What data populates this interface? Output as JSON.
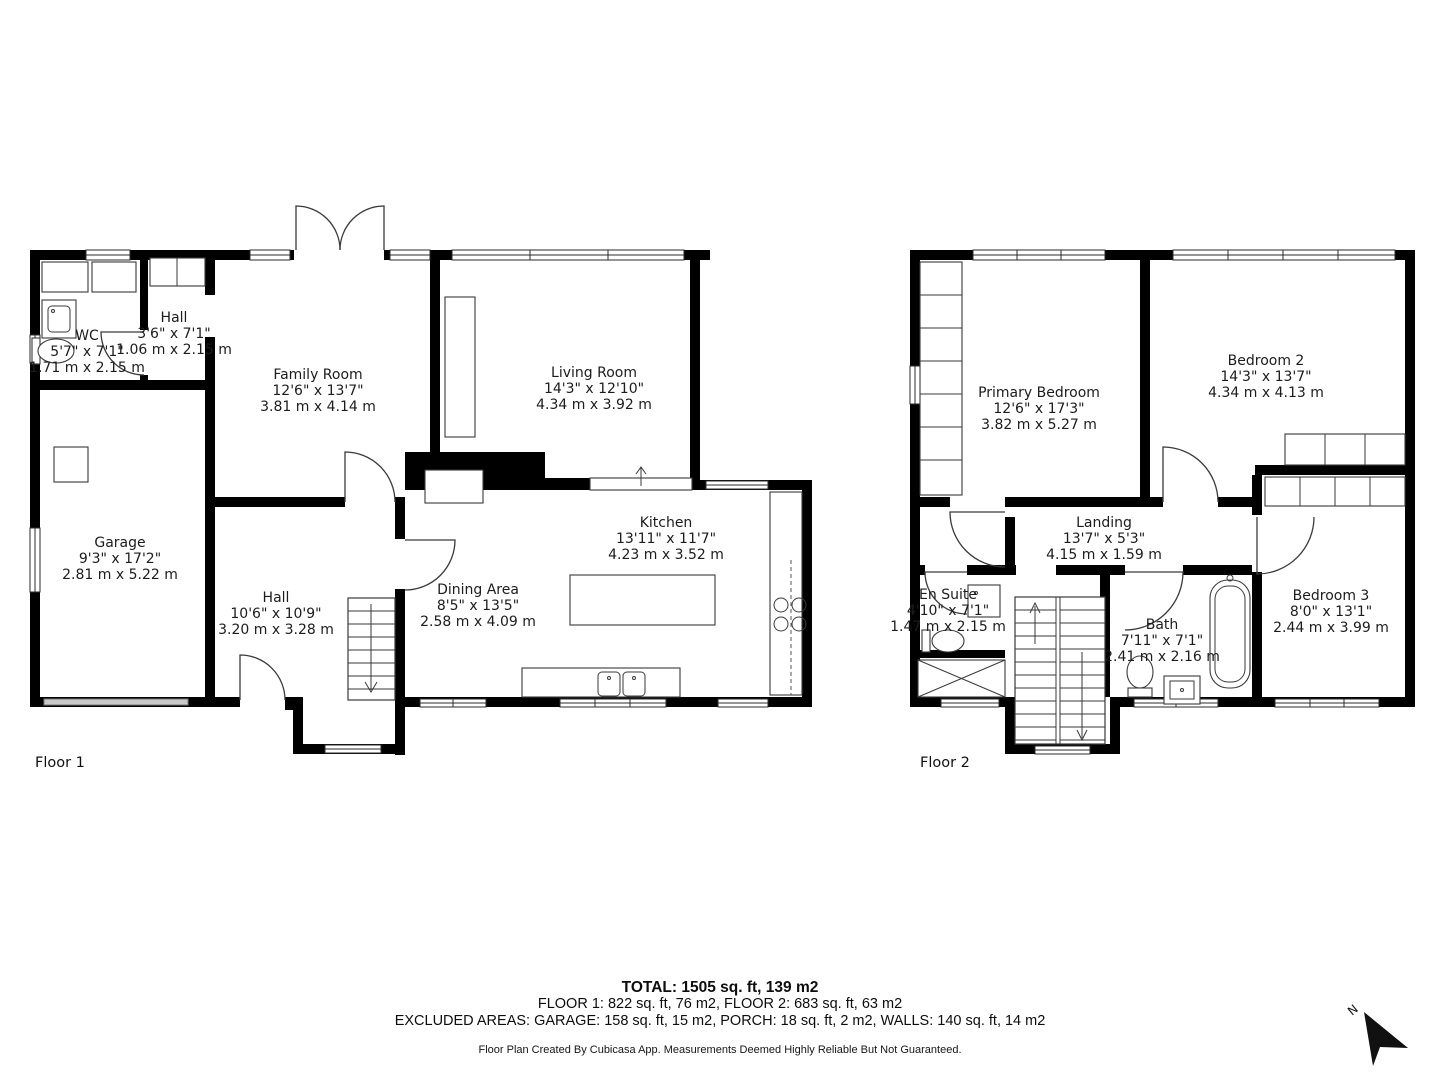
{
  "floors": [
    {
      "label": "Floor 1",
      "rooms": [
        {
          "name": "WC",
          "imperial": "5'7\" x 7'1\"",
          "metric": "1.71 m x 2.15 m"
        },
        {
          "name": "Hall",
          "imperial": "3'6\" x 7'1\"",
          "metric": "1.06 m x 2.15 m"
        },
        {
          "name": "Family Room",
          "imperial": "12'6\" x 13'7\"",
          "metric": "3.81 m x 4.14 m"
        },
        {
          "name": "Living Room",
          "imperial": "14'3\" x 12'10\"",
          "metric": "4.34 m x 3.92 m"
        },
        {
          "name": "Garage",
          "imperial": "9'3\" x 17'2\"",
          "metric": "2.81 m x 5.22 m"
        },
        {
          "name": "Hall",
          "imperial": "10'6\" x 10'9\"",
          "metric": "3.20 m x 3.28 m"
        },
        {
          "name": "Dining Area",
          "imperial": "8'5\" x 13'5\"",
          "metric": "2.58 m x 4.09 m"
        },
        {
          "name": "Kitchen",
          "imperial": "13'11\" x 11'7\"",
          "metric": "4.23 m x 3.52 m"
        }
      ]
    },
    {
      "label": "Floor 2",
      "rooms": [
        {
          "name": "Primary Bedroom",
          "imperial": "12'6\" x 17'3\"",
          "metric": "3.82 m x 5.27 m"
        },
        {
          "name": "Bedroom 2",
          "imperial": "14'3\" x 13'7\"",
          "metric": "4.34 m x 4.13 m"
        },
        {
          "name": "Landing",
          "imperial": "13'7\" x 5'3\"",
          "metric": "4.15 m x 1.59 m"
        },
        {
          "name": "En Suite",
          "imperial": "4'10\" x 7'1\"",
          "metric": "1.47 m x 2.15 m"
        },
        {
          "name": "Bath",
          "imperial": "7'11\" x 7'1\"",
          "metric": "2.41 m x 2.16 m"
        },
        {
          "name": "Bedroom 3",
          "imperial": "8'0\" x 13'1\"",
          "metric": "2.44 m x 3.99 m"
        }
      ]
    }
  ],
  "summary": {
    "total": "TOTAL: 1505 sq. ft, 139 m2",
    "floors_line": "FLOOR 1: 822 sq. ft, 76 m2, FLOOR 2: 683 sq. ft, 63 m2",
    "excluded_line": "EXCLUDED AREAS: GARAGE: 158 sq. ft, 15 m2, PORCH: 18 sq. ft, 2 m2, WALLS: 140 sq. ft, 14 m2",
    "attribution": "Floor Plan Created By Cubicasa App. Measurements Deemed Highly Reliable But Not Guaranteed."
  },
  "compass": {
    "label": "N"
  },
  "colors": {
    "wall": "#000000",
    "background": "#ffffff",
    "line": "#3a3a3a",
    "garage_door": "#c9c9c9"
  }
}
